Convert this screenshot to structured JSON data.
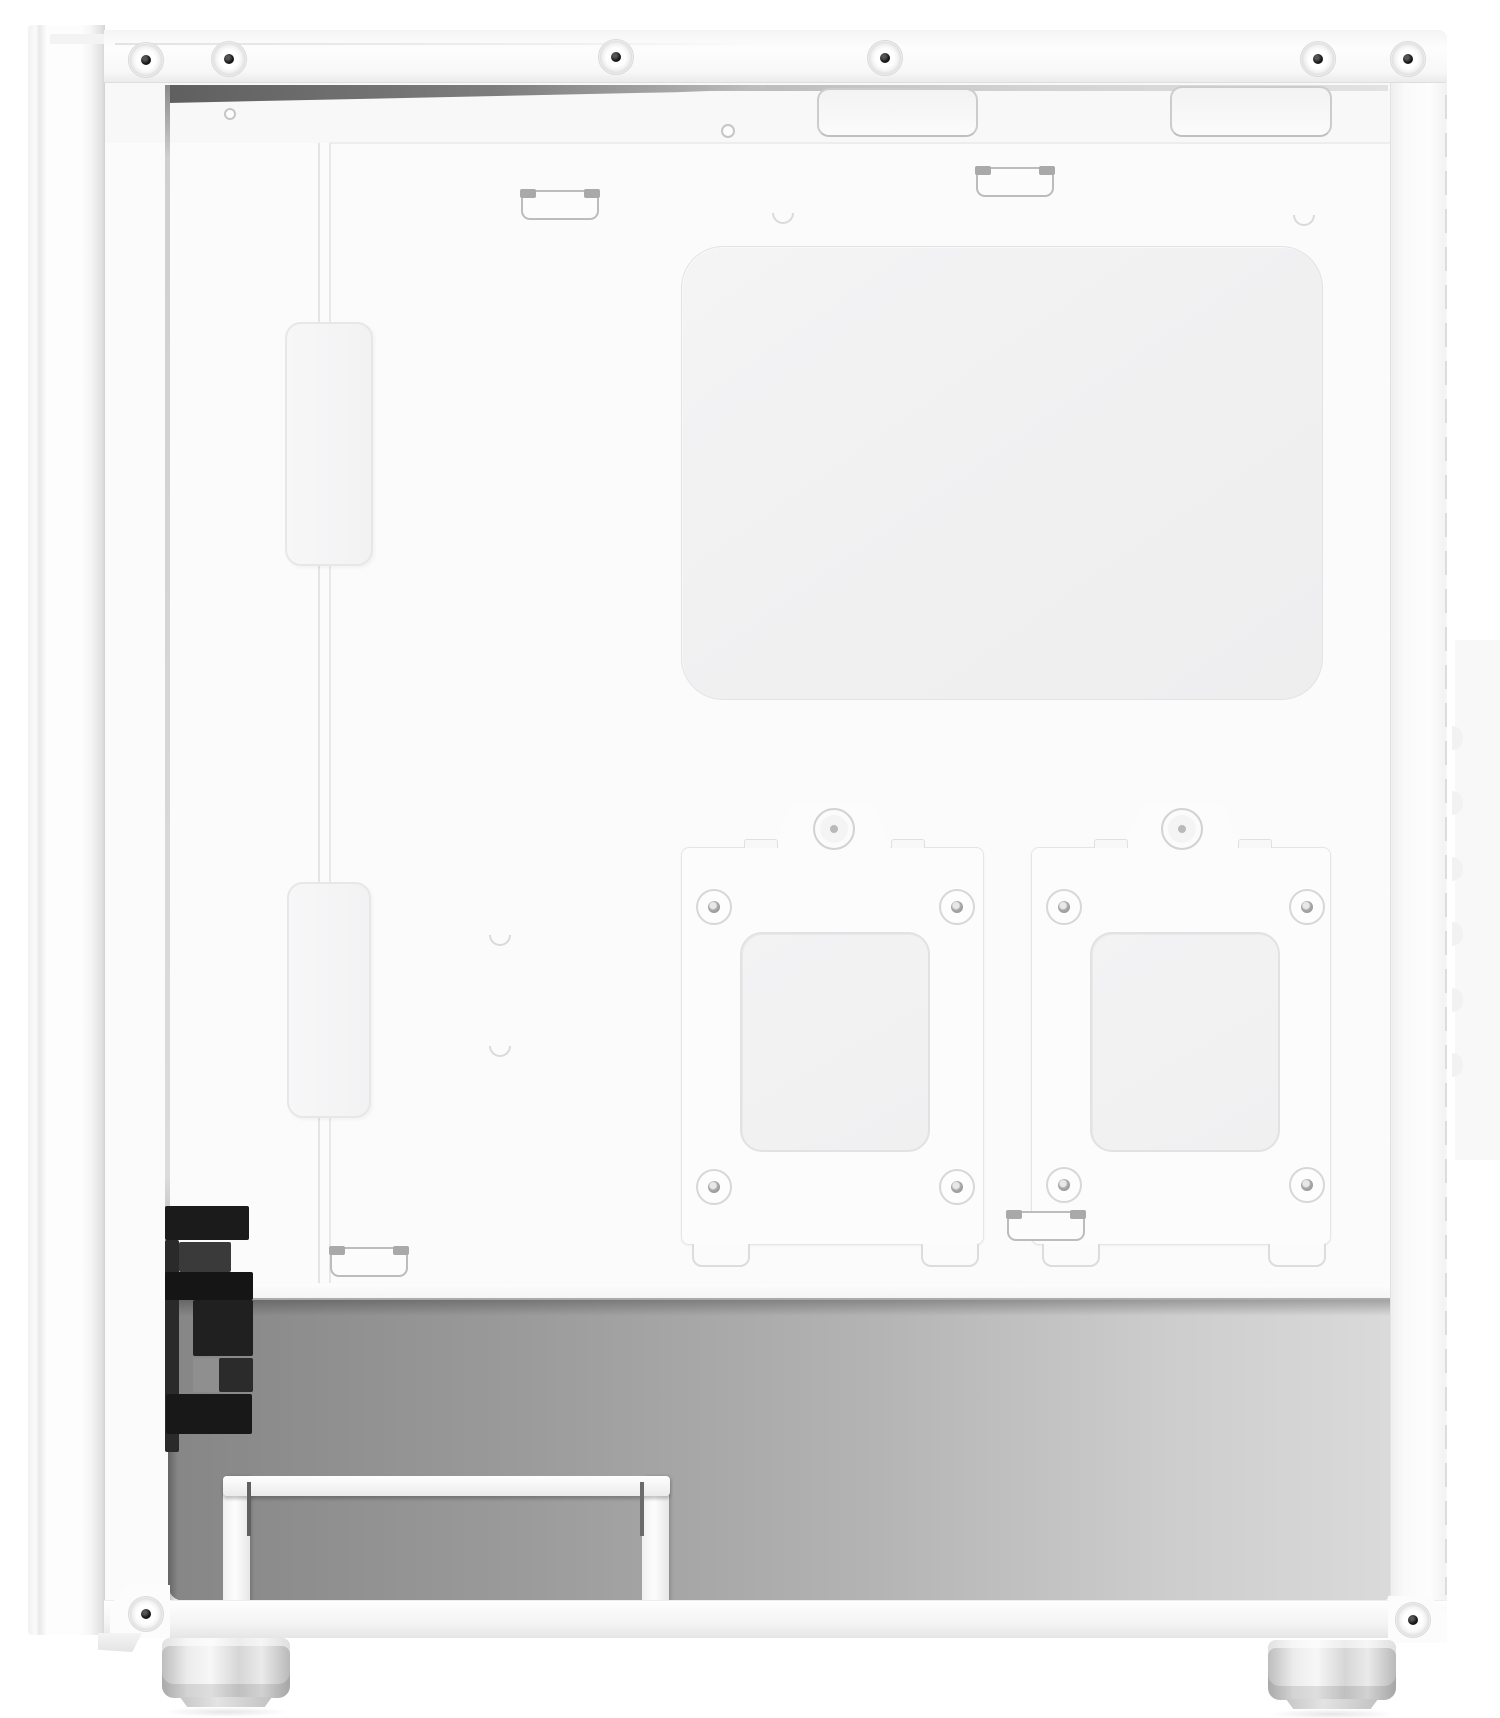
{
  "scene": {
    "description": "White mid-tower PC case photographed from the side with the side panel removed, showing the cable-management side of the motherboard tray: a large rounded CPU cutout cover plate, two removable 2.5-inch SSD mounting brackets with thumbscrews and four rubber grommets each, rubber cable clips along the top and bottom edges, a vertical cable channel with two covers, top cable-routing cutouts, a gray power-supply chamber containing black front-panel I/O cables and a white drive rail bracket, riveted white frame with screws, and two cylindrical case feet.",
    "object": "PC case interior, cable side",
    "finish": "matte white"
  },
  "palette": {
    "background": "#ffffff",
    "case_white": "#fcfcfd",
    "cover_panel_gray": "#f1f1f2",
    "chamber_gray_dark": "#868686",
    "chamber_gray_light": "#dadada",
    "io_cable_black": "#1b1b1b",
    "screw_hole_black": "#1c1c1c"
  },
  "counts": {
    "top_rivet_screws": 6,
    "bottom_rivet_screws": 2,
    "ssd_brackets": 2,
    "grommets_per_bracket": 4,
    "cable_clips": 4,
    "top_cable_cutouts": 2,
    "channel_covers": 2,
    "feet": 2
  },
  "items": [
    {
      "type": "margin-shade",
      "x": 1455,
      "y": 640,
      "w": 45,
      "h": 520,
      "color": "#f8f8f8"
    },
    {
      "type": "rivet-screw",
      "x": 128,
      "y": 42
    },
    {
      "type": "rivet-screw",
      "x": 211,
      "y": 41
    },
    {
      "type": "rivet-screw",
      "x": 598,
      "y": 39
    },
    {
      "type": "rivet-screw",
      "x": 867,
      "y": 40
    },
    {
      "type": "rivet-screw",
      "x": 1300,
      "y": 41
    },
    {
      "type": "rivet-screw",
      "x": 1390,
      "y": 41
    },
    {
      "type": "rivet-screw",
      "x": 128,
      "y": 1596
    },
    {
      "type": "rivet-screw",
      "x": 1395,
      "y": 1602
    },
    {
      "type": "top-cable-cutout",
      "x": 817,
      "y": 88,
      "w": 161,
      "h": 49
    },
    {
      "type": "top-cable-cutout",
      "x": 1170,
      "y": 86,
      "w": 162,
      "h": 51
    },
    {
      "type": "tray-hole",
      "x": 224,
      "y": 108,
      "w": 12,
      "h": 12
    },
    {
      "type": "tray-hole",
      "x": 721,
      "y": 124,
      "w": 14,
      "h": 14
    },
    {
      "type": "tray-dimple",
      "x": 772,
      "y": 213
    },
    {
      "type": "tray-dimple",
      "x": 1293,
      "y": 215
    },
    {
      "type": "tray-dimple",
      "x": 489,
      "y": 935
    },
    {
      "type": "tray-dimple",
      "x": 489,
      "y": 1046
    },
    {
      "type": "channel-cover",
      "x": 285,
      "y": 322,
      "w": 88,
      "h": 244
    },
    {
      "type": "channel-cover",
      "x": 287,
      "y": 882,
      "w": 84,
      "h": 236
    },
    {
      "type": "cable-clip",
      "x": 521,
      "y": 190
    },
    {
      "type": "cable-clip",
      "x": 976,
      "y": 167
    },
    {
      "type": "cable-clip",
      "x": 330,
      "y": 1247
    },
    {
      "type": "cable-clip",
      "x": 1007,
      "y": 1211
    },
    {
      "type": "ssd-thumbscrew",
      "x": 813,
      "y": 808
    },
    {
      "type": "ssd-thumbscrew",
      "x": 1161,
      "y": 808
    },
    {
      "type": "ssd-grommet",
      "x": 696,
      "y": 889
    },
    {
      "type": "ssd-grommet",
      "x": 939,
      "y": 889
    },
    {
      "type": "ssd-grommet",
      "x": 696,
      "y": 1169
    },
    {
      "type": "ssd-grommet",
      "x": 939,
      "y": 1169
    },
    {
      "type": "ssd-grommet",
      "x": 1046,
      "y": 889
    },
    {
      "type": "ssd-grommet",
      "x": 1289,
      "y": 889
    },
    {
      "type": "ssd-grommet",
      "x": 1046,
      "y": 1167
    },
    {
      "type": "ssd-grommet",
      "x": 1289,
      "y": 1167
    },
    {
      "type": "edge-knob",
      "x": 1452,
      "y": 726
    },
    {
      "type": "edge-knob",
      "x": 1452,
      "y": 791
    },
    {
      "type": "edge-knob",
      "x": 1452,
      "y": 857
    },
    {
      "type": "edge-knob",
      "x": 1452,
      "y": 922
    },
    {
      "type": "edge-knob",
      "x": 1452,
      "y": 988
    },
    {
      "type": "edge-knob",
      "x": 1452,
      "y": 1053
    },
    {
      "type": "io-block",
      "x": 165,
      "y": 1206,
      "w": 84,
      "h": 34,
      "color": "#1b1b1b"
    },
    {
      "type": "io-block",
      "x": 165,
      "y": 1240,
      "w": 14,
      "h": 212,
      "color": "#2a2a2a"
    },
    {
      "type": "io-block",
      "x": 179,
      "y": 1242,
      "w": 52,
      "h": 30,
      "color": "#3a3a3a"
    },
    {
      "type": "io-block",
      "x": 165,
      "y": 1272,
      "w": 88,
      "h": 28,
      "color": "#151515"
    },
    {
      "type": "io-block",
      "x": 193,
      "y": 1300,
      "w": 60,
      "h": 56,
      "color": "#202020"
    },
    {
      "type": "io-block",
      "x": 193,
      "y": 1358,
      "w": 26,
      "h": 34,
      "color": "#8f8f8f"
    },
    {
      "type": "io-block",
      "x": 219,
      "y": 1358,
      "w": 34,
      "h": 34,
      "color": "#2b2b2b"
    },
    {
      "type": "io-block",
      "x": 166,
      "y": 1394,
      "w": 86,
      "h": 40,
      "color": "#181818"
    },
    {
      "type": "rail-slot",
      "x": 247,
      "y": 1482,
      "w": 4,
      "h": 54,
      "color": "#606060"
    },
    {
      "type": "rail-slot",
      "x": 640,
      "y": 1482,
      "w": 4,
      "h": 54,
      "color": "#6b6b6b"
    }
  ]
}
